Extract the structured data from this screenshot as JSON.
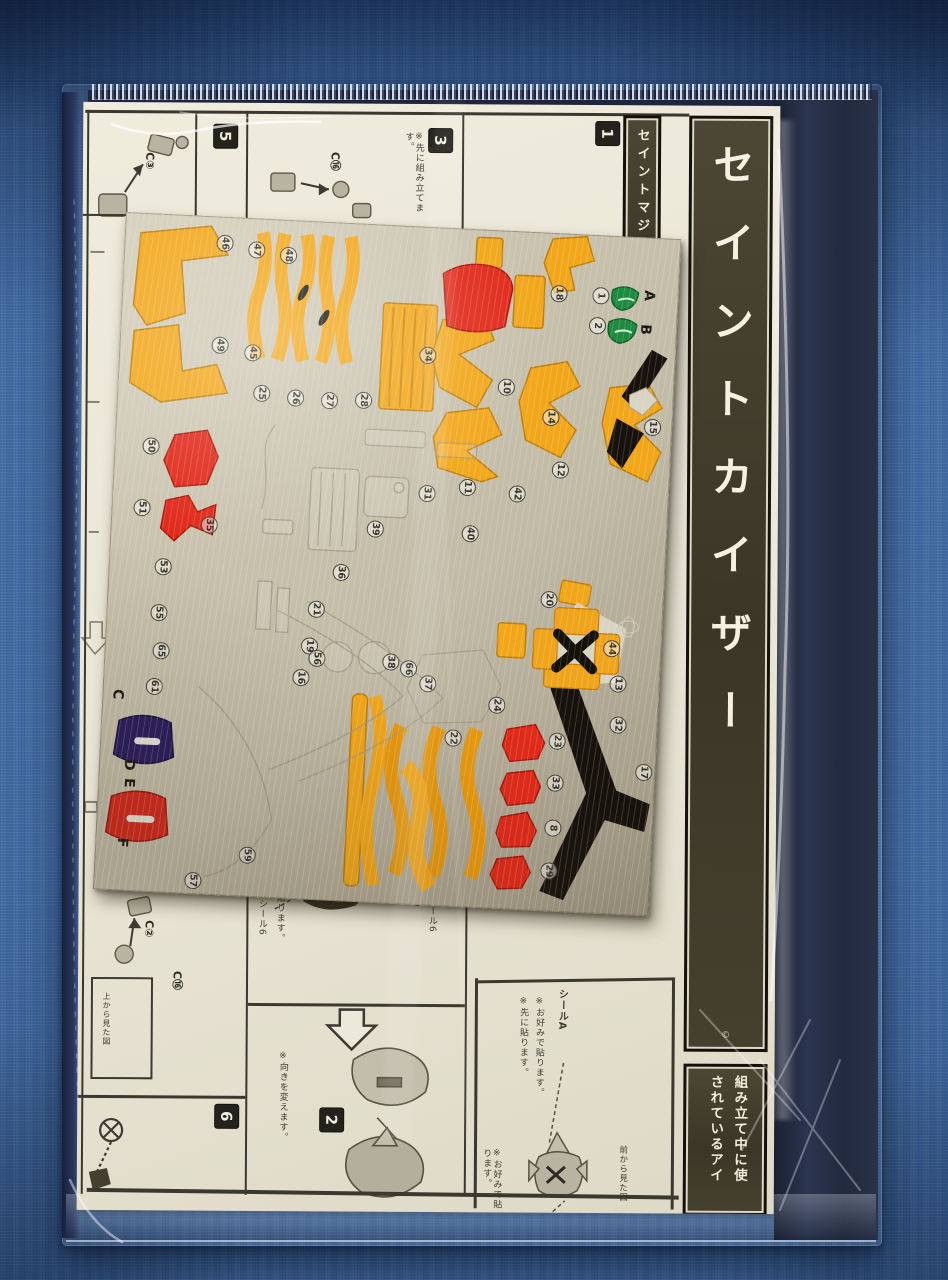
{
  "photo": {
    "subject": "Model kit instruction sheet with metallic sticker sheet inside a clear plastic bag",
    "background": "blue woven fabric"
  },
  "palette": {
    "fabric_blue": "#3f68a0",
    "bag_shadow_navy": "#232c42",
    "paper": "#ece8da",
    "banner_dark": "#45402e",
    "banner_text": "#f4f1e3",
    "sticker_silver": "#c6bfa9",
    "accent_orange": "#f2a71b",
    "accent_red": "#e02a1a",
    "accent_green": "#1f8b40",
    "accent_purple": "#2a1b5e",
    "accent_black": "#17120c"
  },
  "banners": {
    "title": "セイントカイザー",
    "side": "セイントマジン",
    "items_line1": "組み立て中に使",
    "items_line2": "されているアイ",
    "copyright": "©"
  },
  "steps": {
    "s1": "1",
    "s2": "2",
    "s3": "3",
    "s5": "5",
    "s6": "6"
  },
  "part_labels": {
    "c3": "C③",
    "c16_top": "C⑯",
    "c2": "C②",
    "c16_bottom": "C⑯"
  },
  "notes": {
    "pre_assemble": "※先に組み立てます。",
    "seal6_a": "シール6",
    "seal6_b": "シール6",
    "paste": "貼ります。",
    "seal_a": "シールA",
    "seal_b": "シールB",
    "optional": "※お好みで貼ります。",
    "first": "※先に貼ります。",
    "front_view": "前から見た図",
    "top_view": "上から見た図",
    "turn": "※向きを変えます。"
  },
  "sticker_sheet": {
    "letters": [
      {
        "t": "A",
        "x": 521,
        "y": 50
      },
      {
        "t": "B",
        "x": 519,
        "y": 84
      },
      {
        "t": "C",
        "x": 10,
        "y": 474
      },
      {
        "t": "D",
        "x": 24,
        "y": 544
      },
      {
        "t": "E",
        "x": 26,
        "y": 562
      },
      {
        "t": "F",
        "x": 22,
        "y": 622
      }
    ],
    "badges": [
      {
        "n": "46",
        "x": 92,
        "y": 18
      },
      {
        "n": "47",
        "x": 124,
        "y": 23
      },
      {
        "n": "48",
        "x": 156,
        "y": 27
      },
      {
        "n": "49",
        "x": 92,
        "y": 120
      },
      {
        "n": "45",
        "x": 125,
        "y": 126
      },
      {
        "n": "25",
        "x": 136,
        "y": 166
      },
      {
        "n": "26",
        "x": 170,
        "y": 169
      },
      {
        "n": "27",
        "x": 204,
        "y": 170
      },
      {
        "n": "28",
        "x": 238,
        "y": 168
      },
      {
        "n": "18",
        "x": 428,
        "y": 52
      },
      {
        "n": "1",
        "x": 470,
        "y": 52
      },
      {
        "n": "2",
        "x": 468,
        "y": 82
      },
      {
        "n": "10",
        "x": 380,
        "y": 148
      },
      {
        "n": "14",
        "x": 426,
        "y": 176
      },
      {
        "n": "12",
        "x": 438,
        "y": 228
      },
      {
        "n": "15",
        "x": 528,
        "y": 181
      },
      {
        "n": "35",
        "x": 90,
        "y": 300
      },
      {
        "n": "50",
        "x": 28,
        "y": 224
      },
      {
        "n": "51",
        "x": 22,
        "y": 286
      },
      {
        "n": "53",
        "x": 46,
        "y": 344
      },
      {
        "n": "55",
        "x": 44,
        "y": 390
      },
      {
        "n": "65",
        "x": 48,
        "y": 428
      },
      {
        "n": "61",
        "x": 43,
        "y": 464
      },
      {
        "n": "11",
        "x": 346,
        "y": 250
      },
      {
        "n": "31",
        "x": 306,
        "y": 258
      },
      {
        "n": "42",
        "x": 396,
        "y": 254
      },
      {
        "n": "39",
        "x": 256,
        "y": 296
      },
      {
        "n": "40",
        "x": 351,
        "y": 296
      },
      {
        "n": "34",
        "x": 300,
        "y": 120
      },
      {
        "n": "36",
        "x": 224,
        "y": 341
      },
      {
        "n": "21",
        "x": 201,
        "y": 379
      },
      {
        "n": "19",
        "x": 196,
        "y": 416
      },
      {
        "n": "16",
        "x": 189,
        "y": 448
      },
      {
        "n": "56",
        "x": 204,
        "y": 428
      },
      {
        "n": "66",
        "x": 296,
        "y": 434
      },
      {
        "n": "38",
        "x": 278,
        "y": 428
      },
      {
        "n": "37",
        "x": 316,
        "y": 448
      },
      {
        "n": "24",
        "x": 386,
        "y": 466
      },
      {
        "n": "22",
        "x": 344,
        "y": 501
      },
      {
        "n": "20",
        "x": 433,
        "y": 358
      },
      {
        "n": "13",
        "x": 506,
        "y": 439
      },
      {
        "n": "44",
        "x": 498,
        "y": 404
      },
      {
        "n": "23",
        "x": 448,
        "y": 499
      },
      {
        "n": "33",
        "x": 448,
        "y": 541
      },
      {
        "n": "8",
        "x": 448,
        "y": 586
      },
      {
        "n": "29",
        "x": 446,
        "y": 629
      },
      {
        "n": "17",
        "x": 536,
        "y": 526
      },
      {
        "n": "32",
        "x": 508,
        "y": 480
      },
      {
        "n": "57",
        "x": 91,
        "y": 656
      },
      {
        "n": "59",
        "x": 144,
        "y": 628
      }
    ]
  }
}
